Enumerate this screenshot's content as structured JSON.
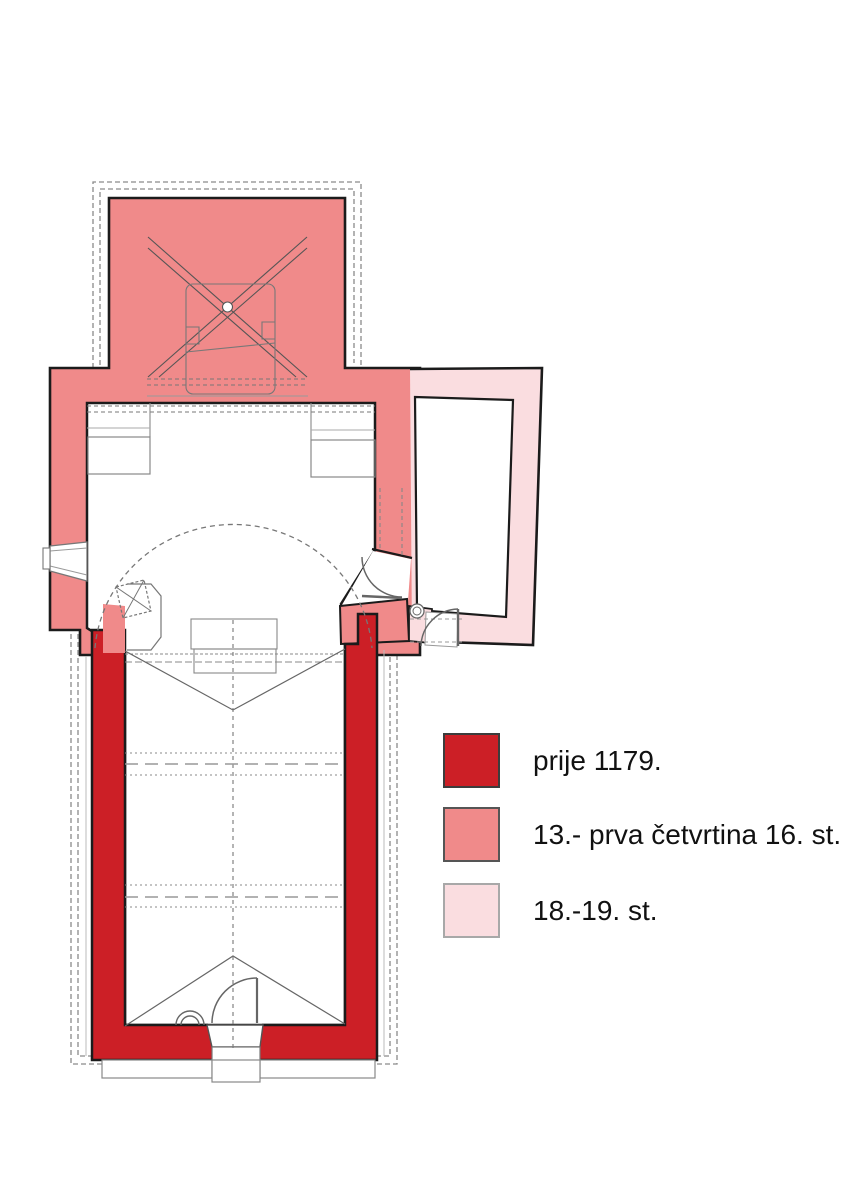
{
  "colors": {
    "phase_before_1179": "#cc1f26",
    "phase_13_to_16": "#f08a8a",
    "phase_18_19": "#fadde0",
    "wall_outline": "#1b1b1b",
    "detail_line": "#8c8c8c",
    "swatch_border_dark": "#3c3c3c",
    "swatch_border_mid": "#555555",
    "swatch_border_light": "#a8a8a8",
    "background": "#ffffff"
  },
  "legend": {
    "items": [
      {
        "label": "prije 1179."
      },
      {
        "label": "13.- prva četvrtina 16. st."
      },
      {
        "label": "18.-19. st."
      }
    ]
  }
}
